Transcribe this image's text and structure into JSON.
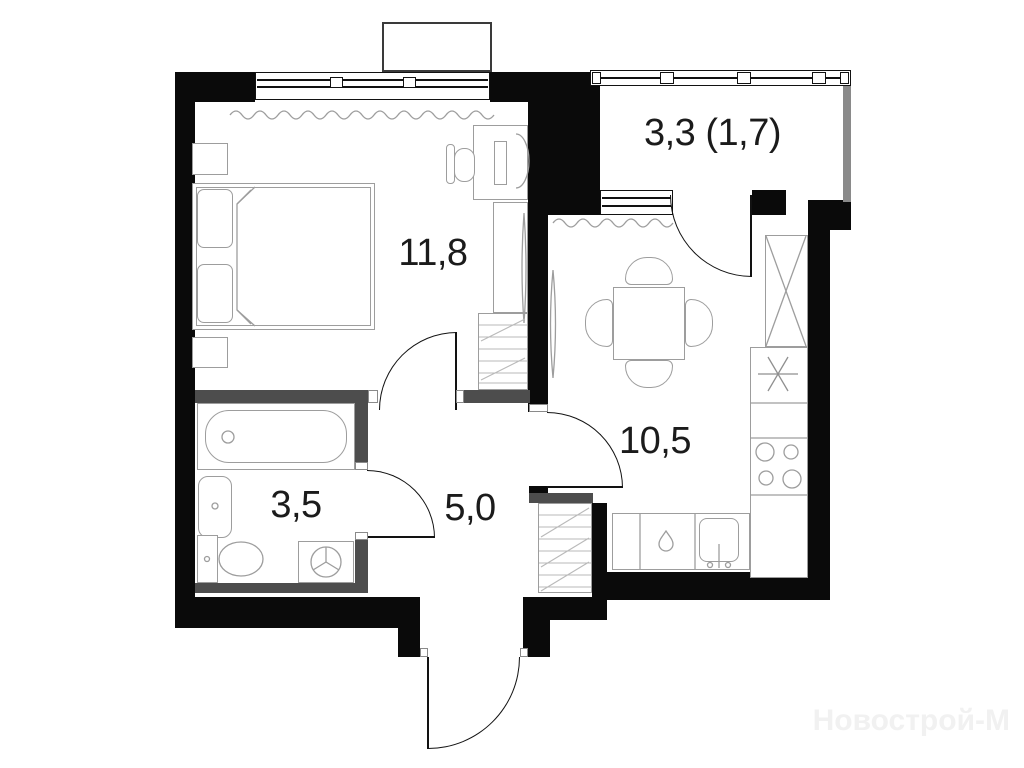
{
  "plan": {
    "rooms": [
      {
        "name": "bedroom",
        "area_label": "11,8"
      },
      {
        "name": "balcony",
        "area_label": "3,3 (1,7)"
      },
      {
        "name": "kitchen",
        "area_label": "10,5"
      },
      {
        "name": "bathroom",
        "area_label": "3,5"
      },
      {
        "name": "hallway",
        "area_label": "5,0"
      }
    ],
    "watermark": "Новострой-М",
    "colors": {
      "exterior_wall": "#0a0a0a",
      "partition_wall": "#4d4d4d",
      "fixture_outline": "#9d9d9d",
      "hatch": "#b9b9b9",
      "label_text": "#1b1b1b",
      "watermark_text": "#f1f1f1",
      "balcony_glass": "#8a8a8a"
    },
    "fixtures": [
      "bed",
      "pillow",
      "nightstand",
      "desk",
      "office-chair",
      "monitor",
      "wardrobe",
      "shelving-unit",
      "bathtub",
      "washbasin",
      "toilet",
      "washing-machine",
      "dining-table",
      "dining-chair",
      "fridge",
      "cooktop",
      "kitchen-sink",
      "extractor-asterisk",
      "radiator-wave",
      "storage-closet",
      "window",
      "balcony-glazing",
      "door-arc"
    ]
  }
}
